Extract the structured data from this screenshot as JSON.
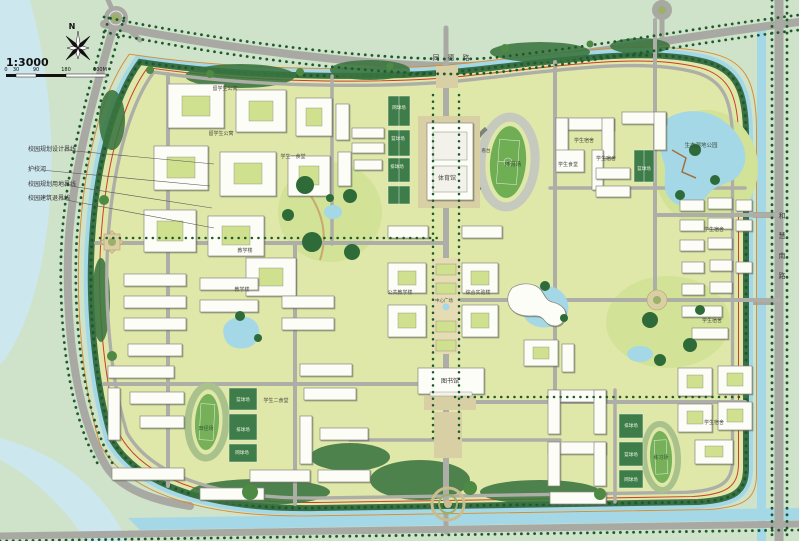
{
  "compass": {
    "north_label": "N"
  },
  "scale": {
    "ratio": "1:3000",
    "ticks": [
      "0",
      "30",
      "90",
      "180",
      "300M"
    ]
  },
  "legend_callouts": [
    {
      "label": "校园规划设计界线"
    },
    {
      "label": "护校河"
    },
    {
      "label": "校园规划用地界线"
    },
    {
      "label": "校园建筑退界线"
    }
  ],
  "roads": {
    "top_road": "同德路",
    "right_road": "和慧南路"
  },
  "colors": {
    "outer_background": "#cfe2ca",
    "campus_ground": "#dfe7a9",
    "water": "#a5d8e6",
    "road": "#a9a9a4",
    "tree_dark": "#1d5a2c",
    "building": "#fdfdf8",
    "boundary_red_line": "#d03a28",
    "boundary_orange_line": "#d98c2c",
    "court_green": "#3e7d4a"
  },
  "map_labels": [
    {
      "t": "同德路",
      "x": 455,
      "y": 60,
      "s": 7,
      "c": "#3c3c3c",
      "ls": 8
    },
    {
      "t": "和慧南路",
      "x": 782,
      "y": 218,
      "s": 7,
      "c": "#3c3c3c",
      "v": true,
      "gap": 20
    },
    {
      "t": "生态湿地公园",
      "x": 701,
      "y": 147,
      "s": 5.5,
      "c": "#3a4a35"
    },
    {
      "t": "学生宿舍",
      "x": 584,
      "y": 142,
      "s": 5,
      "c": "#4a4a44"
    },
    {
      "t": "学生宿舍",
      "x": 606,
      "y": 160,
      "s": 5,
      "c": "#4a4a44"
    },
    {
      "t": "学生食堂",
      "x": 568,
      "y": 166,
      "s": 5,
      "c": "#4a4a44"
    },
    {
      "t": "篮球场",
      "x": 644,
      "y": 170,
      "s": 4.5,
      "c": "#eef4e4"
    },
    {
      "t": "学生宿舍",
      "x": 714,
      "y": 231,
      "s": 5,
      "c": "#4a4a44"
    },
    {
      "t": "学生宿舍",
      "x": 712,
      "y": 322,
      "s": 5,
      "c": "#4a4a44"
    },
    {
      "t": "学生宿舍",
      "x": 714,
      "y": 424,
      "s": 5,
      "c": "#4a4a44"
    },
    {
      "t": "体育馆",
      "x": 447,
      "y": 180,
      "s": 6,
      "c": "#4a4a44"
    },
    {
      "t": "看台",
      "x": 486,
      "y": 152,
      "s": 4.5,
      "c": "#4a4a44"
    },
    {
      "t": "体育场",
      "x": 513,
      "y": 166,
      "s": 5.5,
      "c": "#3a4a35"
    },
    {
      "t": "网球场",
      "x": 399,
      "y": 109,
      "s": 4.5,
      "c": "#eef4e4"
    },
    {
      "t": "篮球场",
      "x": 398,
      "y": 140,
      "s": 4.5,
      "c": "#eef4e4"
    },
    {
      "t": "排球场",
      "x": 397,
      "y": 168,
      "s": 4.5,
      "c": "#eef4e4"
    },
    {
      "t": "留学生公寓",
      "x": 225,
      "y": 90,
      "s": 5,
      "c": "#4a4a44"
    },
    {
      "t": "留学生公寓",
      "x": 221,
      "y": 135,
      "s": 5,
      "c": "#4a4a44"
    },
    {
      "t": "学生一食堂",
      "x": 293,
      "y": 158,
      "s": 5,
      "c": "#4a4a44"
    },
    {
      "t": "教学楼",
      "x": 245,
      "y": 252,
      "s": 5,
      "c": "#4a4a44"
    },
    {
      "t": "教学楼",
      "x": 242,
      "y": 291,
      "s": 5,
      "c": "#4a4a44"
    },
    {
      "t": "公共教学楼",
      "x": 400,
      "y": 294,
      "s": 5,
      "c": "#4a4a44"
    },
    {
      "t": "综合实验楼",
      "x": 478,
      "y": 294,
      "s": 5,
      "c": "#4a4a44"
    },
    {
      "t": "中心广场",
      "x": 444,
      "y": 302,
      "s": 4.5,
      "c": "#4a4a44"
    },
    {
      "t": "图书馆",
      "x": 450,
      "y": 383,
      "s": 6,
      "c": "#333333"
    },
    {
      "t": "学生二食堂",
      "x": 276,
      "y": 402,
      "s": 5,
      "c": "#4a4a44"
    },
    {
      "t": "田径场",
      "x": 206,
      "y": 430,
      "s": 5,
      "c": "#2e5633"
    },
    {
      "t": "篮球场",
      "x": 243,
      "y": 401,
      "s": 4.5,
      "c": "#eef4e4"
    },
    {
      "t": "排球场",
      "x": 243,
      "y": 431,
      "s": 4.5,
      "c": "#eef4e4"
    },
    {
      "t": "网球场",
      "x": 242,
      "y": 454,
      "s": 4.5,
      "c": "#eef4e4"
    },
    {
      "t": "练习场",
      "x": 661,
      "y": 459,
      "s": 5,
      "c": "#2e5633"
    },
    {
      "t": "排球场",
      "x": 631,
      "y": 427,
      "s": 4.5,
      "c": "#eef4e4"
    },
    {
      "t": "篮球场",
      "x": 631,
      "y": 456,
      "s": 4.5,
      "c": "#eef4e4"
    },
    {
      "t": "网球场",
      "x": 631,
      "y": 481,
      "s": 4.5,
      "c": "#eef4e4"
    }
  ]
}
